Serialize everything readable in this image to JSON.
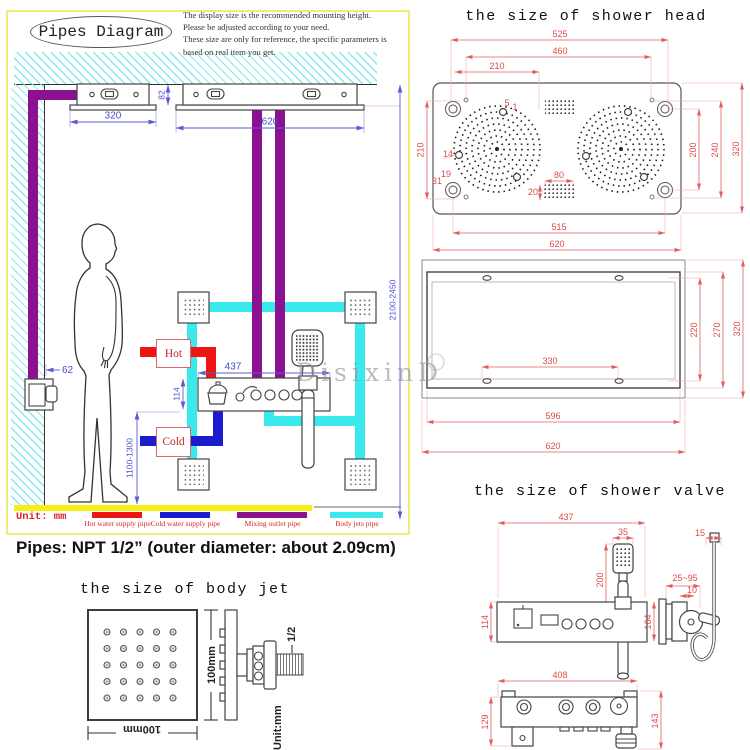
{
  "watermark": "DisixinD",
  "pipes_diagram": {
    "title": "Pipes Diagram",
    "disclaimer_lines": [
      "The display size is the recommended mounting height.",
      "Please be adjusted according to your need.",
      "These size are only for reference, the specific parameters is based on real item you get."
    ],
    "unit_label": "Unit: mm",
    "hot_label": "Hot",
    "cold_label": "Cold",
    "dims": {
      "left_panel_width": "320",
      "right_panel_width": "620",
      "panel_gap": "82",
      "wall_valve_offset": "62",
      "valve_width": "437",
      "valve_height": "114",
      "valve_mount_height": "1100-1300",
      "ceiling_mount_height": "2100-2450"
    },
    "legend": [
      {
        "label": "Hot water supply pipe",
        "color": "#ee1515"
      },
      {
        "label": "Cold water supply pipe",
        "color": "#1c1ccf"
      },
      {
        "label": "Mixing outlet pipe",
        "color": "#8a1290"
      },
      {
        "label": "Body jets pipe",
        "color": "#3ae9ec"
      }
    ]
  },
  "pipes_note": "Pipes: NPT 1/2” (outer diameter: about 2.09cm)",
  "shower_head": {
    "title": "the size of shower head",
    "front_dims": {
      "d525": "525",
      "d460": "460",
      "d210_top": "210",
      "d5": "5",
      "d1": "1",
      "d210_left": "210",
      "d14": "14",
      "d19": "19",
      "d31": "31",
      "d200": "200",
      "d240": "240",
      "d320": "320",
      "d80": "80",
      "d20": "20",
      "d515": "515",
      "d620": "620"
    },
    "box_dims": {
      "d330": "330",
      "d596": "596",
      "d620": "620",
      "d220": "220",
      "d270": "270",
      "d320": "320"
    }
  },
  "shower_valve": {
    "title": "the size of shower valve",
    "dims": {
      "d437": "437",
      "d35": "35",
      "d200": "200",
      "d15": "15",
      "d25_95": "25~95",
      "d10": "10",
      "d104": "104",
      "d114": "114",
      "d408": "408",
      "d129": "129",
      "d143": "143"
    }
  },
  "body_jet": {
    "title": "the size of body jet",
    "width_label": "100mm",
    "height_label": "100mm",
    "thread_label": "1/2",
    "unit_label": "Unit:mm"
  }
}
